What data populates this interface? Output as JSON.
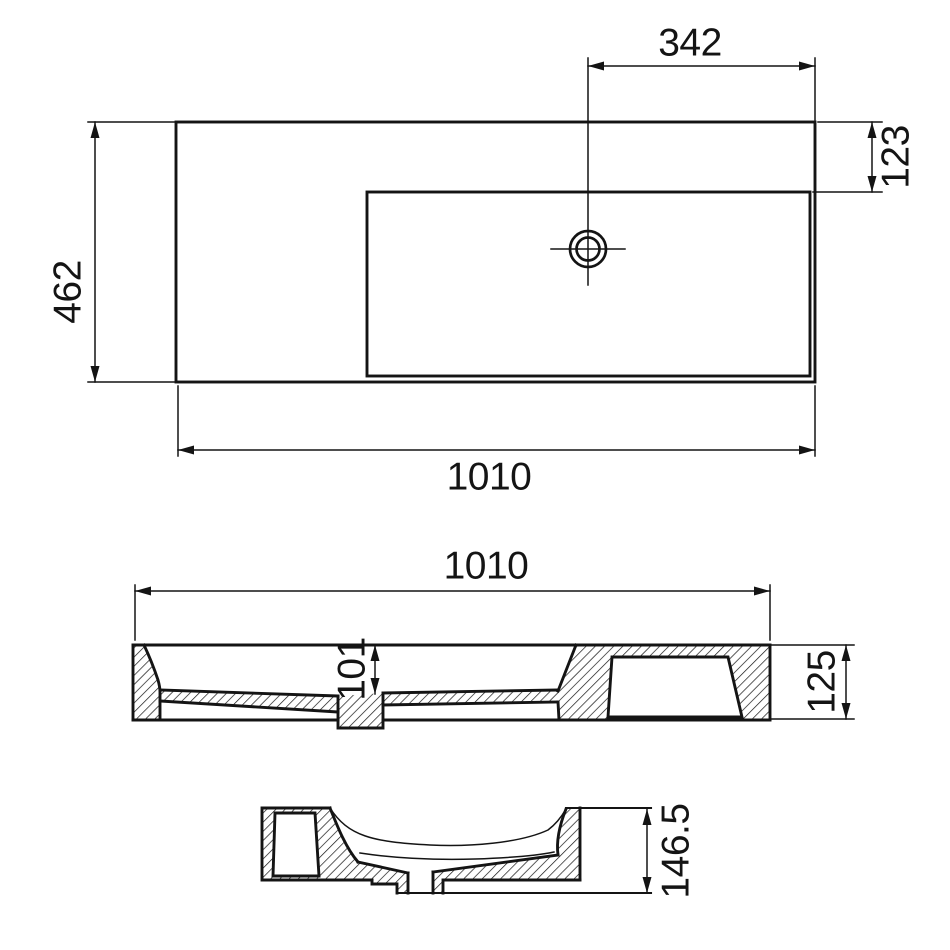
{
  "document": {
    "kind": "technical drawing — wall-mounted washbasin, three orthographic views",
    "background_color": "#ffffff",
    "line_color": "#141414"
  },
  "dimensions": {
    "faucet_offset": "342",
    "deck_depth": "123",
    "overall_depth": "462",
    "overall_width_plan": "1010",
    "overall_width_section": "1010",
    "basin_inner_depth": "101",
    "body_height": "125",
    "overall_height": "146.5"
  }
}
